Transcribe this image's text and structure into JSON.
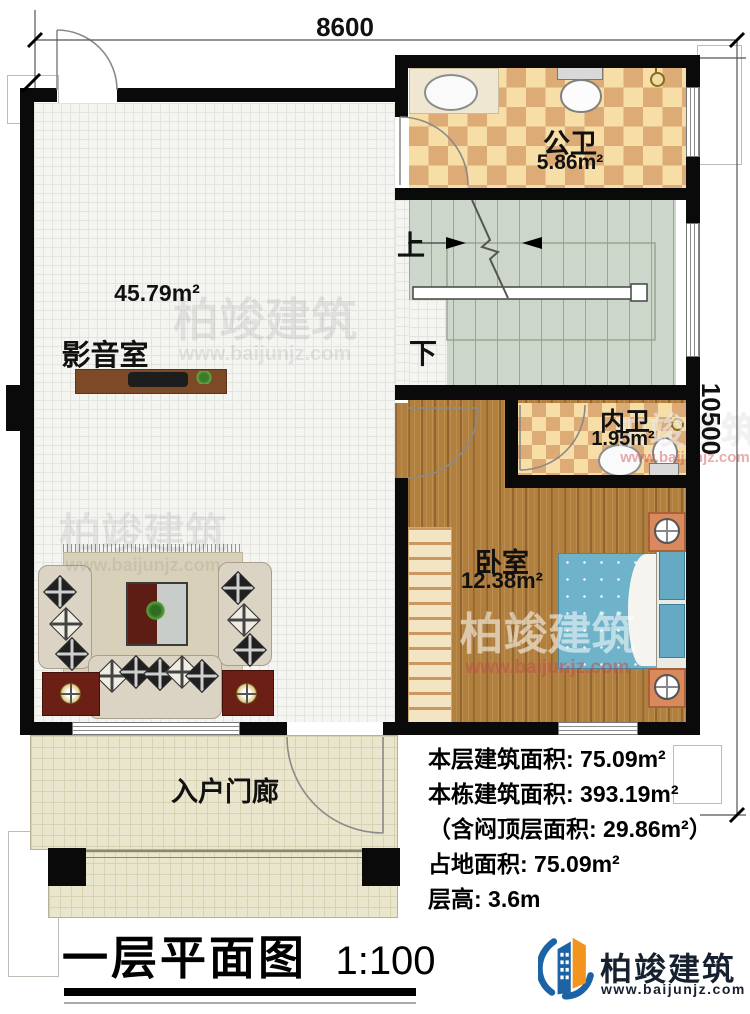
{
  "dimensions": {
    "top": "8600",
    "right": "10500"
  },
  "stairs": {
    "up": "上",
    "down": "下"
  },
  "rooms": {
    "gongwei": {
      "name": "公卫",
      "area": "5.86m²"
    },
    "media": {
      "name": "影音室",
      "area": "45.79m²"
    },
    "neiwei": {
      "name": "内卫",
      "area": "1.95m²"
    },
    "bedroom": {
      "name": "卧室",
      "area": "12.38m²"
    },
    "porch": {
      "name": "入户门廊"
    }
  },
  "info": {
    "lines": [
      "本层建筑面积: 75.09m²",
      "本栋建筑面积: 393.19m²",
      "（含闷顶层面积: 29.86m²）",
      "占地面积: 75.09m²",
      "层高: 3.6m"
    ]
  },
  "title": {
    "text": "一层平面图",
    "scale": "1:100"
  },
  "logo": {
    "name": "柏竣建筑",
    "url": "www.baijunjz.com"
  },
  "watermark": {
    "text": "柏竣建筑",
    "url": "www.baijunjz.com"
  },
  "colors": {
    "wall": "#0a0a0a",
    "tile_light": "#f7dda6",
    "tile_dark": "#dcab76",
    "wood": "#b1803f",
    "stair_floor": "#cdd6ca",
    "bed_blue": "#6fb3ca",
    "porch_floor": "#eae6ce",
    "logo_navy": "#16202e",
    "logo_blue": "#1c63a6",
    "logo_orange": "#f2941d",
    "watermark_red": "#c84b50"
  }
}
